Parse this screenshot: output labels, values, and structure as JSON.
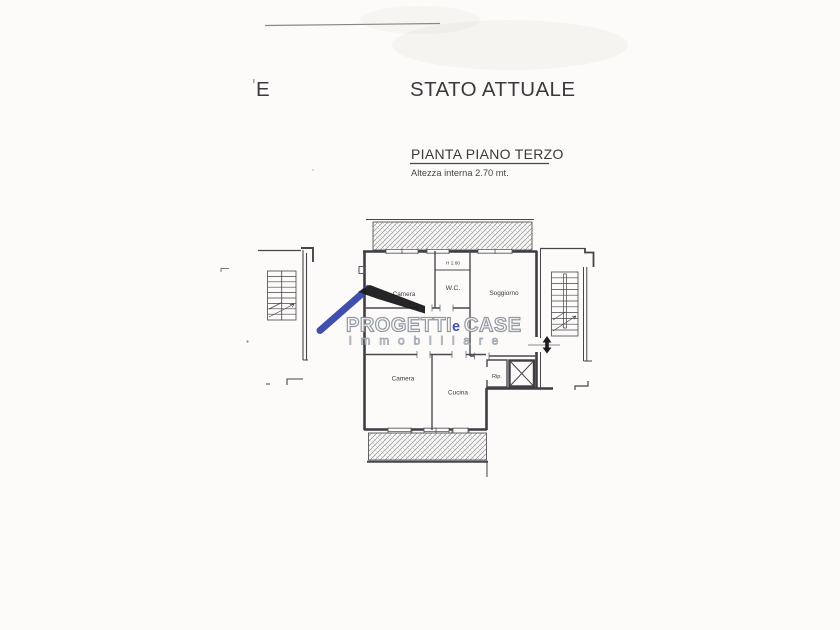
{
  "page": {
    "partial_text": "E",
    "title": "STATO ATTUALE",
    "plan_heading": "PIANTA PIANO TERZO",
    "plan_note": "Altezza interna 2.70 mt."
  },
  "floorplan": {
    "labels": {
      "camera_top": "Camera",
      "wc": "W.C.",
      "wc_height": "H 2.60",
      "soggiorno": "Soggiorno",
      "camera_bottom": "Camera",
      "cucina": "Cucina",
      "ripostiglio": "Rip."
    },
    "line_color": "#45454a"
  },
  "watermark": {
    "word1": "PROGETTI",
    "word2": "e",
    "word3": "CASE",
    "word4": "immobiliare",
    "accent_blue": "#3646a8",
    "outline_gray": "#8d93a0",
    "roof_black": "#1a1a1d"
  }
}
